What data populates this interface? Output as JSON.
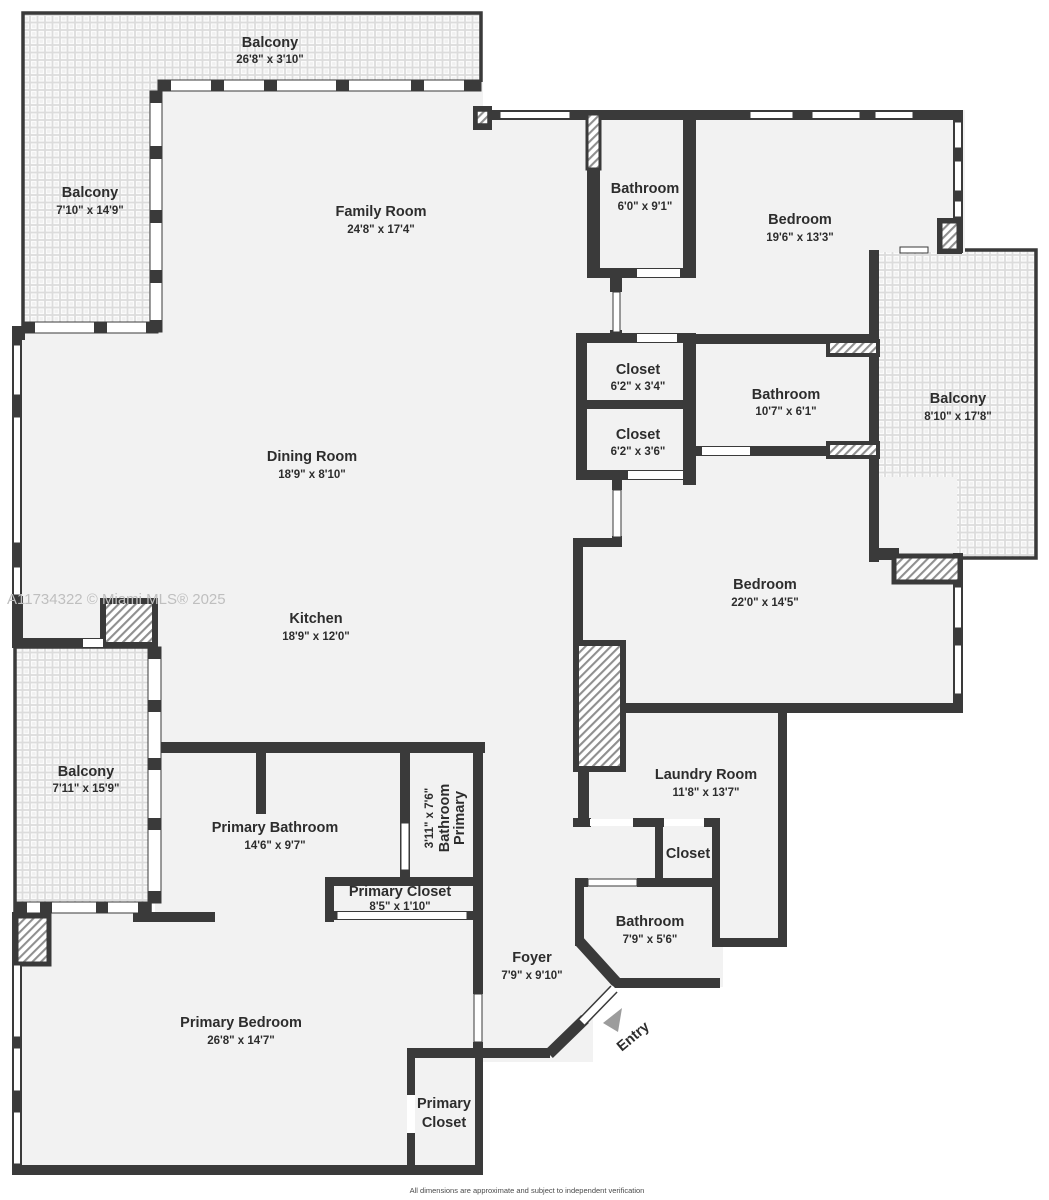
{
  "plan": {
    "watermark": "A11734322 © Miami MLS® 2025",
    "disclaimer": "All dimensions are approximate and subject to independent verification",
    "entry_label": "Entry",
    "colors": {
      "wall": "#3a3a3a",
      "floor": "#f2f2f2",
      "label_text": "#2d2d2d",
      "watermark": "#bfbfbf",
      "entry_arrow": "#9c9c9c"
    },
    "rooms": [
      {
        "id": "balcony-top",
        "name": "Balcony",
        "dims": "26'8\" x 3'10\""
      },
      {
        "id": "balcony-left",
        "name": "Balcony",
        "dims": "7'10\" x 14'9\""
      },
      {
        "id": "family-room",
        "name": "Family Room",
        "dims": "24'8\" x 17'4\""
      },
      {
        "id": "bathroom-top",
        "name": "Bathroom",
        "dims": "6'0\" x 9'1\""
      },
      {
        "id": "bedroom-top",
        "name": "Bedroom",
        "dims": "19'6\" x 13'3\""
      },
      {
        "id": "balcony-right",
        "name": "Balcony",
        "dims": "8'10\" x 17'8\""
      },
      {
        "id": "closet-1",
        "name": "Closet",
        "dims": "6'2\" x 3'4\""
      },
      {
        "id": "bathroom-mid",
        "name": "Bathroom",
        "dims": "10'7\" x 6'1\""
      },
      {
        "id": "closet-2",
        "name": "Closet",
        "dims": "6'2\" x 3'6\""
      },
      {
        "id": "dining-room",
        "name": "Dining Room",
        "dims": "18'9\" x 8'10\""
      },
      {
        "id": "bedroom-right",
        "name": "Bedroom",
        "dims": "22'0\" x 14'5\""
      },
      {
        "id": "kitchen",
        "name": "Kitchen",
        "dims": "18'9\" x 12'0\""
      },
      {
        "id": "balcony-bottom-left",
        "name": "Balcony",
        "dims": "7'11\" x 15'9\""
      },
      {
        "id": "primary-bathroom",
        "name": "Primary Bathroom",
        "dims": "14'6\" x 9'7\""
      },
      {
        "id": "primary-bathroom-small",
        "name": "Primary Bathroom",
        "lines": [
          "Primary",
          "Bathroom"
        ],
        "dims": "3'11\" x 7'6\""
      },
      {
        "id": "laundry-room",
        "name": "Laundry Room",
        "dims": "11'8\" x 13'7\""
      },
      {
        "id": "closet-laundry",
        "name": "Closet"
      },
      {
        "id": "primary-closet",
        "name": "Primary Closet",
        "dims": "8'5\" x 1'10\""
      },
      {
        "id": "bathroom-bottom",
        "name": "Bathroom",
        "dims": "7'9\" x 5'6\""
      },
      {
        "id": "foyer",
        "name": "Foyer",
        "dims": "7'9\" x 9'10\""
      },
      {
        "id": "primary-bedroom",
        "name": "Primary Bedroom",
        "dims": "26'8\" x 14'7\""
      },
      {
        "id": "primary-closet-2",
        "name": "Primary Closet",
        "lines": [
          "Primary",
          "Closet"
        ]
      }
    ]
  }
}
